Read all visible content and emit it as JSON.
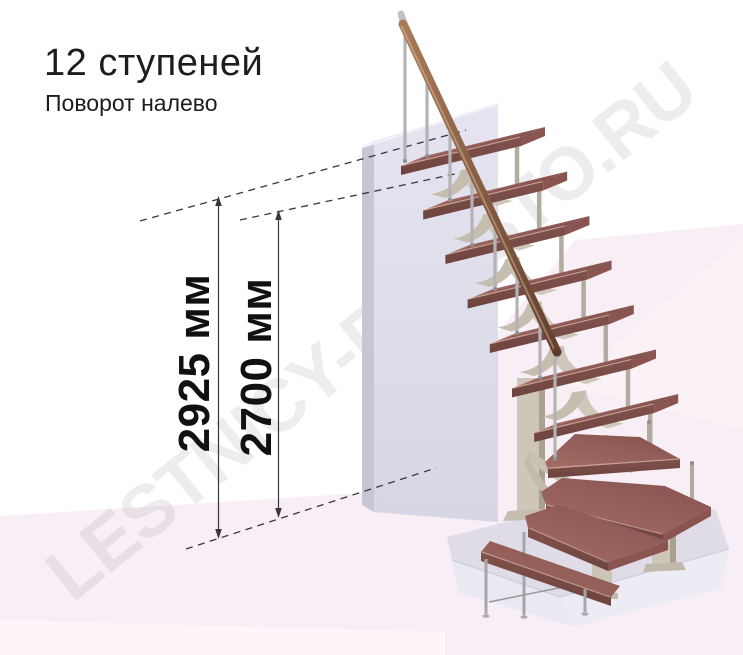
{
  "header": {
    "title": "12 ступеней",
    "subtitle": "Поворот налево"
  },
  "dimensions": {
    "overall_height": {
      "label": "2925 мм"
    },
    "walk_height": {
      "label": "2700 мм"
    }
  },
  "watermark": {
    "text": "LESTNICY-PROSTO.RU"
  },
  "stairs": {
    "steps_count": 12,
    "turn_direction": "налево",
    "colors": {
      "tread_wood": "#9c655f",
      "tread_front": "#7d4f4a",
      "metal_baluster": "#b3b3b5",
      "handrail_wood": "#8a5a42",
      "support_column": "#cdc6b9",
      "wall": "#dfdeea",
      "floor_pink": "#f8eef5",
      "platform": "#dfdce8",
      "dimension_line": "#39363f"
    }
  }
}
